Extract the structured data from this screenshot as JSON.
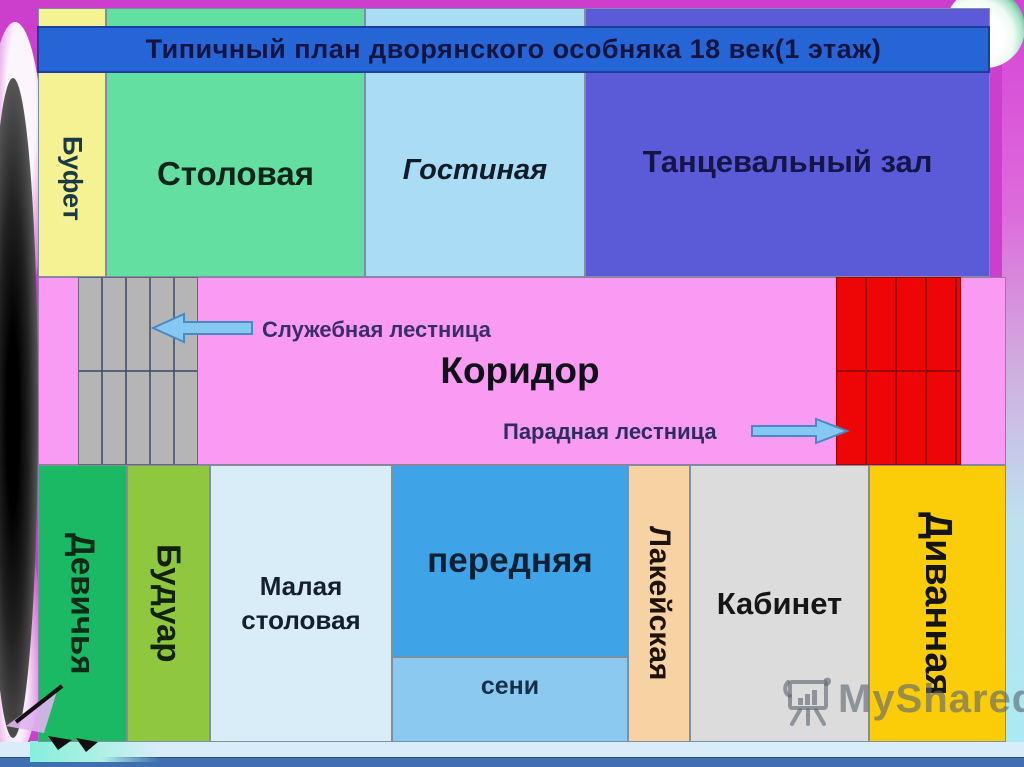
{
  "slide": {
    "title": "Типичный план дворянского особняка 18 век(1 этаж)"
  },
  "rooms": {
    "bufet": {
      "label": "Буфет",
      "color": "#f5f294"
    },
    "stolovaya": {
      "label": "Столовая",
      "color": "#63dfa2"
    },
    "gostinaya": {
      "label": "Гостиная",
      "color": "#aadcf5"
    },
    "tantsevalny_zal": {
      "label": "Танцевальный зал",
      "color": "#5b5bd7"
    },
    "koridor": {
      "label": "Коридор",
      "color": "#f99bf2"
    },
    "devichya": {
      "label": "Девичья",
      "color": "#1cb965"
    },
    "buduar": {
      "label": "Будуар",
      "color": "#8fc83f"
    },
    "malaya_stolovaya": {
      "label": "Малая столовая",
      "color": "#d9edf9"
    },
    "perednyaya": {
      "label": "передняя",
      "color": "#3fa3e8"
    },
    "seni": {
      "label": "сени",
      "color": "#8cc9f0"
    },
    "lakeyskaya": {
      "label": "Лакейская",
      "color": "#f7d2a3"
    },
    "kabinet": {
      "label": "Кабинет",
      "color": "#dcdcdc"
    },
    "divannaya": {
      "label": "Диванная",
      "color": "#fbcd09"
    }
  },
  "stairs": {
    "service": {
      "label": "Служебная лестница",
      "direction": "left",
      "steps_color": "#b5b5b5"
    },
    "grand": {
      "label": "Парадная лестница",
      "direction": "right",
      "steps_color": "#ee0606"
    }
  },
  "watermark": {
    "label": "MyShared",
    "icon": "presentation-easel-icon"
  },
  "colors": {
    "background_magenta": "#cc3fcc",
    "title_bar_blue": "#2565d5",
    "arrow_fill": "#85c8f2",
    "arrow_border": "#4a88c8",
    "bottom_bar_blue": "#3f6fae",
    "bottom_background": "#d9ecf9"
  }
}
